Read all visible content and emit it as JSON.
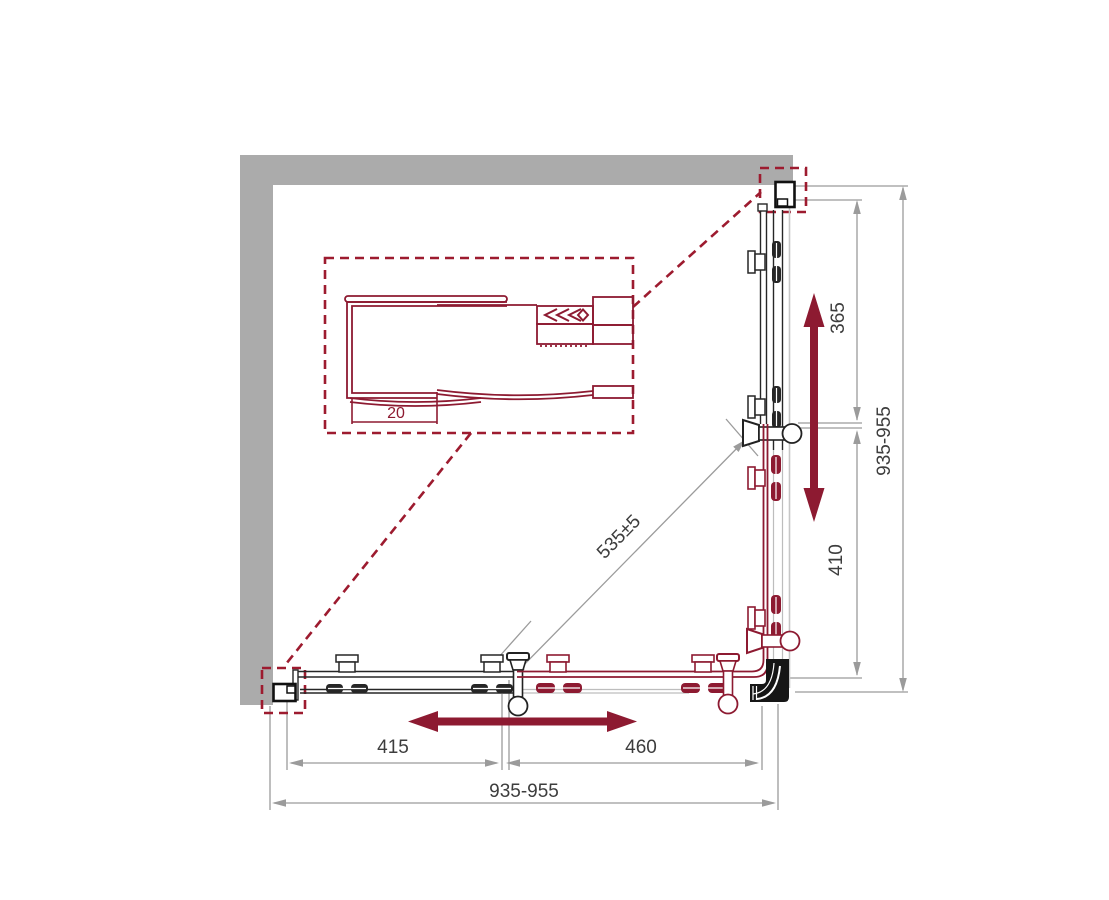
{
  "drawing": {
    "title": "corner shower enclosure dimension drawing",
    "dimensions": {
      "right_upper": "365",
      "right_lower": "410",
      "right_total": "935-955",
      "bottom_left": "415",
      "bottom_right": "460",
      "bottom_total": "935-955",
      "diagonal": "535±5",
      "profile_depth": "20"
    },
    "colors": {
      "accent_maroon": "#8d1a31",
      "wall_gray": "#ababab",
      "dimension_gray": "#9b9b9b",
      "line_dark": "#262626",
      "glass_gray": "#c6c6c6"
    }
  }
}
